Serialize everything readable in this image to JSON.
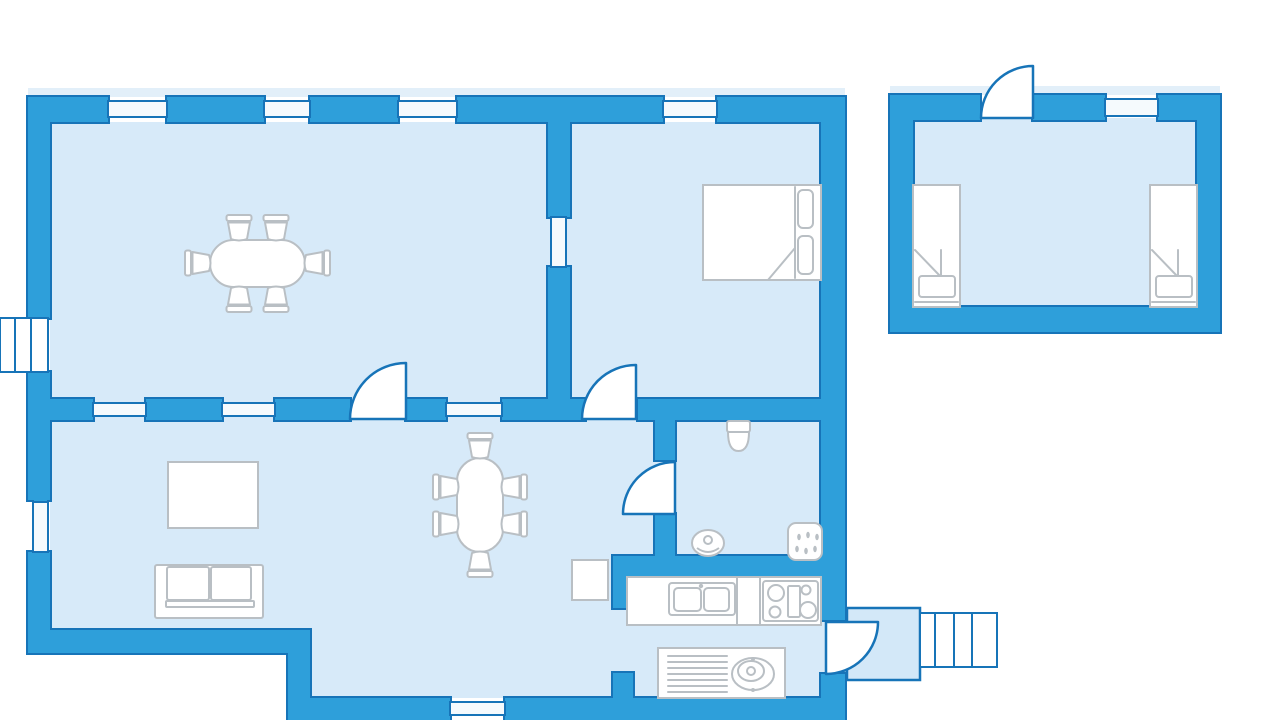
{
  "canvas": {
    "width": 1280,
    "height": 720
  },
  "colors": {
    "wall": "#2E9FDA",
    "wall_line": "#1774B8",
    "floor": "#D7EAF9",
    "window": "#F5FAFD",
    "shadow": "#E2EFF9",
    "furn_line": "#B9BFC4",
    "white": "#FFFFFF",
    "landing": "#D3E8F8"
  },
  "shadow_bands": [
    {
      "name": "main-house-outer-shadow",
      "x": 28,
      "y": 88,
      "w": 817,
      "h": 9
    },
    {
      "name": "annex-outer-shadow",
      "x": 890,
      "y": 86,
      "w": 330,
      "h": 9
    }
  ],
  "floors": [
    {
      "name": "main-house-floor",
      "x": 50,
      "y": 122,
      "w": 771,
      "h": 510
    },
    {
      "name": "kitchen-lower-floor",
      "x": 310,
      "y": 632,
      "w": 511,
      "h": 66
    },
    {
      "name": "entrance-doorway-floor",
      "x": 821,
      "y": 620,
      "w": 26,
      "h": 55
    },
    {
      "name": "annex-floor",
      "x": 913,
      "y": 118,
      "w": 284,
      "h": 189
    }
  ],
  "landing": {
    "name": "entrance-landing",
    "x": 847,
    "y": 608,
    "w": 73,
    "h": 72
  },
  "steps": {
    "name": "entrance-steps",
    "x": 920,
    "y": 613,
    "w": 77,
    "h": 54,
    "dividers": [
      935,
      954,
      972
    ]
  },
  "walls": [
    {
      "name": "top-wall-a",
      "x": 28,
      "y": 97,
      "w": 80,
      "h": 25
    },
    {
      "name": "top-wall-b",
      "x": 167,
      "y": 97,
      "w": 97,
      "h": 25
    },
    {
      "name": "top-wall-c",
      "x": 310,
      "y": 97,
      "w": 88,
      "h": 25
    },
    {
      "name": "top-wall-d",
      "x": 457,
      "y": 97,
      "w": 206,
      "h": 25
    },
    {
      "name": "top-wall-e",
      "x": 717,
      "y": 97,
      "w": 128,
      "h": 25
    },
    {
      "name": "left-wall-a",
      "x": 28,
      "y": 97,
      "w": 22,
      "h": 221
    },
    {
      "name": "left-wall-b",
      "x": 28,
      "y": 372,
      "w": 22,
      "h": 128
    },
    {
      "name": "left-wall-c",
      "x": 28,
      "y": 552,
      "w": 22,
      "h": 80
    },
    {
      "name": "bottom-wall-upper",
      "x": 28,
      "y": 630,
      "w": 282,
      "h": 23
    },
    {
      "name": "step-wall",
      "x": 288,
      "y": 630,
      "w": 22,
      "h": 90
    },
    {
      "name": "bottom-wall-lower-a",
      "x": 288,
      "y": 698,
      "w": 162,
      "h": 22
    },
    {
      "name": "bottom-wall-lower-b",
      "x": 505,
      "y": 698,
      "w": 340,
      "h": 22
    },
    {
      "name": "right-wall-a",
      "x": 821,
      "y": 97,
      "w": 24,
      "h": 523
    },
    {
      "name": "right-wall-b",
      "x": 821,
      "y": 674,
      "w": 24,
      "h": 46
    },
    {
      "name": "room-divider-vertical-a",
      "x": 548,
      "y": 122,
      "w": 22,
      "h": 95
    },
    {
      "name": "room-divider-vertical-b",
      "x": 548,
      "y": 267,
      "w": 22,
      "h": 132
    },
    {
      "name": "mid-wall-a",
      "x": 50,
      "y": 399,
      "w": 43,
      "h": 21
    },
    {
      "name": "mid-wall-b",
      "x": 146,
      "y": 399,
      "w": 76,
      "h": 21
    },
    {
      "name": "mid-wall-c",
      "x": 275,
      "y": 399,
      "w": 75,
      "h": 21
    },
    {
      "name": "mid-wall-d",
      "x": 406,
      "y": 399,
      "w": 40,
      "h": 21
    },
    {
      "name": "mid-wall-e",
      "x": 502,
      "y": 399,
      "w": 83,
      "h": 21
    },
    {
      "name": "mid-wall-f",
      "x": 638,
      "y": 399,
      "w": 207,
      "h": 21
    },
    {
      "name": "bathroom-wall-a",
      "x": 655,
      "y": 420,
      "w": 20,
      "h": 40
    },
    {
      "name": "bathroom-wall-b",
      "x": 655,
      "y": 514,
      "w": 20,
      "h": 44
    },
    {
      "name": "kitchen-top-wall",
      "x": 613,
      "y": 556,
      "w": 232,
      "h": 21
    },
    {
      "name": "kitchen-door-wall",
      "x": 613,
      "y": 556,
      "w": 20,
      "h": 52
    },
    {
      "name": "kitchen-stub-wall",
      "x": 613,
      "y": 673,
      "w": 20,
      "h": 25
    },
    {
      "name": "annex-top-wall-a",
      "x": 890,
      "y": 95,
      "w": 90,
      "h": 25
    },
    {
      "name": "annex-top-wall-b",
      "x": 1033,
      "y": 95,
      "w": 72,
      "h": 25
    },
    {
      "name": "annex-top-wall-c",
      "x": 1158,
      "y": 95,
      "w": 62,
      "h": 25
    },
    {
      "name": "annex-left-wall",
      "x": 890,
      "y": 95,
      "w": 23,
      "h": 237
    },
    {
      "name": "annex-right-wall",
      "x": 1197,
      "y": 95,
      "w": 23,
      "h": 237
    },
    {
      "name": "annex-bottom-wall",
      "x": 890,
      "y": 307,
      "w": 330,
      "h": 25
    }
  ],
  "windows": [
    {
      "name": "window-top-1",
      "x": 108,
      "y": 101,
      "w": 59,
      "h": 16,
      "orient": "h"
    },
    {
      "name": "window-top-2",
      "x": 264,
      "y": 101,
      "w": 46,
      "h": 16,
      "orient": "h"
    },
    {
      "name": "window-top-3",
      "x": 398,
      "y": 101,
      "w": 59,
      "h": 16,
      "orient": "h"
    },
    {
      "name": "window-top-4",
      "x": 663,
      "y": 101,
      "w": 54,
      "h": 16,
      "orient": "h"
    },
    {
      "name": "window-mid-1",
      "x": 93,
      "y": 403,
      "w": 53,
      "h": 13,
      "orient": "h"
    },
    {
      "name": "window-mid-2",
      "x": 222,
      "y": 403,
      "w": 53,
      "h": 13,
      "orient": "h"
    },
    {
      "name": "window-mid-3",
      "x": 446,
      "y": 403,
      "w": 56,
      "h": 13,
      "orient": "h"
    },
    {
      "name": "window-divider",
      "x": 551,
      "y": 217,
      "w": 15,
      "h": 50,
      "orient": "v"
    },
    {
      "name": "window-left",
      "x": 33,
      "y": 502,
      "w": 15,
      "h": 50,
      "orient": "v"
    },
    {
      "name": "window-bottom",
      "x": 450,
      "y": 702,
      "w": 55,
      "h": 13,
      "orient": "h"
    },
    {
      "name": "window-annex",
      "x": 1105,
      "y": 99,
      "w": 53,
      "h": 17,
      "orient": "h"
    }
  ],
  "bay_window": {
    "name": "bay-window",
    "x": 0,
    "y": 318,
    "w": 48,
    "h": 54,
    "dividers": [
      15,
      31
    ]
  },
  "doors": [
    {
      "name": "dining-room-door",
      "path": "M406,419 L406,363 A56,56 0 0 0 350,419 Z"
    },
    {
      "name": "bedroom-door",
      "path": "M636,419 L636,365 A54,54 0 0 0 582,419 Z"
    },
    {
      "name": "bathroom-door",
      "path": "M675,514 L675,462 A52,52 0 0 0 623,514 Z"
    },
    {
      "name": "annex-door",
      "path": "M1033,118 L1033,66 A52,52 0 0 0 981,118 Z"
    },
    {
      "name": "entrance-door",
      "path": "M826,622 L878,622 A52,52 0 0 1 826,674 Z"
    }
  ],
  "furniture": [
    {
      "name": "dining-table",
      "type": "pill",
      "x": 210,
      "y": 240,
      "w": 95,
      "h": 47
    },
    {
      "name": "dining-chair-1",
      "type": "chair",
      "cx": 239,
      "cy": 227,
      "dir": "down"
    },
    {
      "name": "dining-chair-2",
      "type": "chair",
      "cx": 276,
      "cy": 227,
      "dir": "down"
    },
    {
      "name": "dining-chair-3",
      "type": "chair",
      "cx": 239,
      "cy": 300,
      "dir": "up"
    },
    {
      "name": "dining-chair-4",
      "type": "chair",
      "cx": 276,
      "cy": 300,
      "dir": "up"
    },
    {
      "name": "dining-chair-5",
      "type": "chair",
      "cx": 197,
      "cy": 263,
      "dir": "right"
    },
    {
      "name": "dining-chair-6",
      "type": "chair",
      "cx": 318,
      "cy": 263,
      "dir": "left"
    },
    {
      "name": "coffee-table",
      "type": "rect",
      "x": 168,
      "y": 462,
      "w": 90,
      "h": 66
    },
    {
      "name": "sofa",
      "type": "sofa",
      "x": 155,
      "y": 565,
      "w": 108,
      "h": 53
    },
    {
      "name": "living-table",
      "type": "pill",
      "x": 457,
      "y": 458,
      "w": 46,
      "h": 94
    },
    {
      "name": "living-chair-1",
      "type": "chair",
      "cx": 480,
      "cy": 445,
      "dir": "down"
    },
    {
      "name": "living-chair-2",
      "type": "chair",
      "cx": 480,
      "cy": 565,
      "dir": "up"
    },
    {
      "name": "living-chair-3",
      "type": "chair",
      "cx": 445,
      "cy": 487,
      "dir": "right"
    },
    {
      "name": "living-chair-4",
      "type": "chair",
      "cx": 445,
      "cy": 524,
      "dir": "right"
    },
    {
      "name": "living-chair-5",
      "type": "chair",
      "cx": 515,
      "cy": 487,
      "dir": "left"
    },
    {
      "name": "living-chair-6",
      "type": "chair",
      "cx": 515,
      "cy": 524,
      "dir": "left"
    },
    {
      "name": "side-table",
      "type": "rect",
      "x": 572,
      "y": 560,
      "w": 36,
      "h": 40
    },
    {
      "name": "double-bed",
      "type": "bedDouble",
      "x": 703,
      "y": 185,
      "w": 118,
      "h": 95
    },
    {
      "name": "single-bed-left",
      "type": "bedSingle",
      "x": 913,
      "y": 185,
      "w": 47,
      "h": 122
    },
    {
      "name": "single-bed-right",
      "type": "bedSingle",
      "x": 1150,
      "y": 185,
      "w": 47,
      "h": 122
    },
    {
      "name": "toilet",
      "type": "toilet",
      "cx": 738.5,
      "y": 421
    },
    {
      "name": "washbasin",
      "type": "basin",
      "cx": 708,
      "cy": 543
    },
    {
      "name": "shower",
      "type": "shower",
      "x": 788,
      "y": 523,
      "w": 34,
      "h": 37
    },
    {
      "name": "kitchen-counter",
      "type": "counter",
      "x": 627,
      "y": 577,
      "w": 194,
      "h": 48,
      "dividers": [
        737,
        760
      ],
      "sink": {
        "x": 669,
        "y": 583,
        "w": 66,
        "h": 32,
        "b1": [
          674,
          588,
          27,
          23
        ],
        "b2": [
          704,
          588,
          25,
          23
        ],
        "faucet": [
          701,
          586
        ]
      },
      "stove": {
        "x": 763,
        "y": 581,
        "w": 55,
        "h": 40,
        "burners": [
          [
            776,
            593,
            8
          ],
          [
            775,
            612,
            5.5
          ],
          [
            806,
            590,
            4.5
          ],
          [
            808,
            610,
            8
          ]
        ],
        "grid": [
          788,
          586,
          12,
          31
        ]
      }
    },
    {
      "name": "kitchen-drainer-sink",
      "type": "drainer",
      "x": 658,
      "y": 648,
      "w": 127,
      "h": 50,
      "lines": {
        "x1": 668,
        "x2": 727,
        "ys": [
          656,
          662,
          668,
          674,
          680,
          686,
          692
        ]
      },
      "basin": {
        "cx": 753,
        "cy": 674,
        "rx": 21,
        "ry": 16,
        "inner": [
          751,
          671,
          13,
          10
        ],
        "dot": [
          751,
          671,
          4
        ],
        "taps": [
          [
            753,
            659
          ],
          [
            753,
            690
          ]
        ]
      }
    }
  ]
}
